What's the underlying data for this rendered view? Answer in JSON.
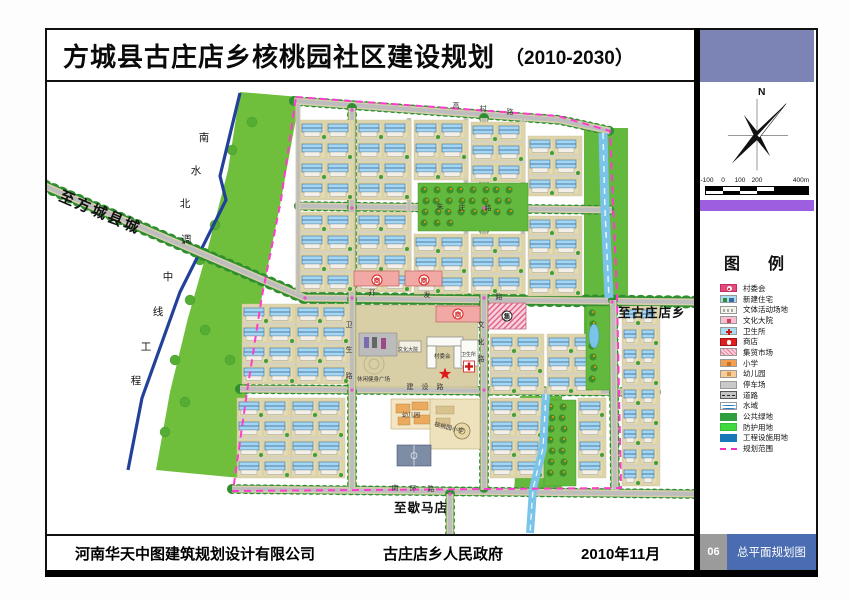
{
  "title": {
    "main": "方城县古庄店乡核桃园社区建设规划",
    "period": "（2010-2030）"
  },
  "compass": {
    "north_label": "N"
  },
  "scale_bar": {
    "tick_labels": [
      "-100",
      "0",
      "100",
      "200",
      "400m"
    ]
  },
  "legend": {
    "title": "图　例",
    "items": [
      {
        "key": "cunweihui",
        "label": "村委会"
      },
      {
        "key": "xinjian",
        "label": "新建住宅"
      },
      {
        "key": "wenti",
        "label": "文体活动场地"
      },
      {
        "key": "wenhua",
        "label": "文化大院"
      },
      {
        "key": "weisheng",
        "label": "卫生所"
      },
      {
        "key": "shangdian",
        "label": "商店"
      },
      {
        "key": "jimao",
        "label": "集贸市场"
      },
      {
        "key": "xiaoxue",
        "label": "小学"
      },
      {
        "key": "youeryuan",
        "label": "幼儿园"
      },
      {
        "key": "tingche",
        "label": "停车场"
      },
      {
        "key": "daolu",
        "label": "道路"
      },
      {
        "key": "shuiyu",
        "label": "水域"
      },
      {
        "key": "lvdi",
        "label": "公共绿地"
      },
      {
        "key": "fanghu",
        "label": "防护用地"
      },
      {
        "key": "gongcheng",
        "label": "工程设施用地"
      },
      {
        "key": "guihua",
        "label": "规划范围"
      }
    ]
  },
  "map": {
    "labels": {
      "to_fangcheng": "至方城县城",
      "canal": "南水北调中线工程",
      "to_guzhuangdian": "至古庄店乡",
      "to_xiemadian": "至歇马店"
    },
    "roads": {
      "gaocun": "高村路",
      "zhuzhuang": "朱庄路",
      "kaifa": "开发路",
      "jianshe": "建设路",
      "nanhuan": "南环路",
      "weisheng": "卫生路",
      "wenhua": "文化路"
    },
    "facilities": {
      "plaza": "休闲健身广场",
      "cultural_yard": "文化大院",
      "village_committee": "村委会",
      "clinic": "卫生所",
      "kindergarten": "幼儿园",
      "school": "核桃园小学"
    },
    "symbols": {
      "shop": "商",
      "market": "集"
    }
  },
  "footer": {
    "company": "河南华天中图建筑规划设计有限公司",
    "government": "古庄店乡人民政府",
    "date": "2010年11月",
    "sheet_number": "06",
    "sheet_name": "总平面规划图"
  },
  "colors": {
    "boundary": "#ff3ccc",
    "public_green": "#2f9e3f",
    "protective_green": "#6fbf3d",
    "engineering_blue": "#1878b8",
    "sidebar_slate": "#7b84b4",
    "sidebar_purple": "#9d5fe0",
    "sheet_name_blue": "#4a6cb0"
  }
}
